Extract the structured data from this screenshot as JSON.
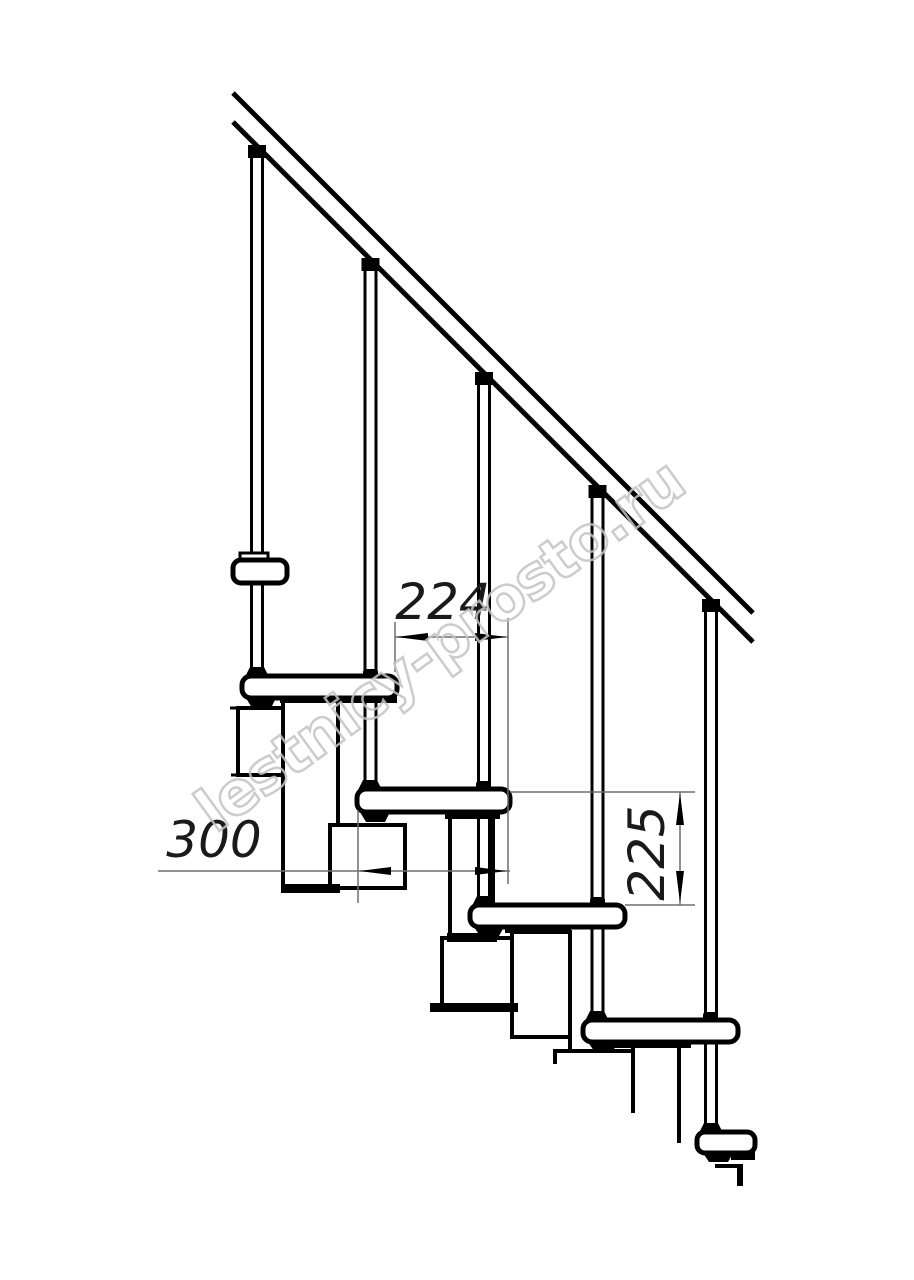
{
  "drawing": {
    "dimensions": {
      "step_run": "224",
      "tread_depth": "300",
      "step_rise": "225"
    },
    "watermark": {
      "text": "lestnicy-prosto.ru"
    },
    "colors": {
      "line": "#000000",
      "dimension_line": "#6e6e6e",
      "watermark_outline": "#c4c4c4",
      "background": "#ffffff"
    }
  }
}
